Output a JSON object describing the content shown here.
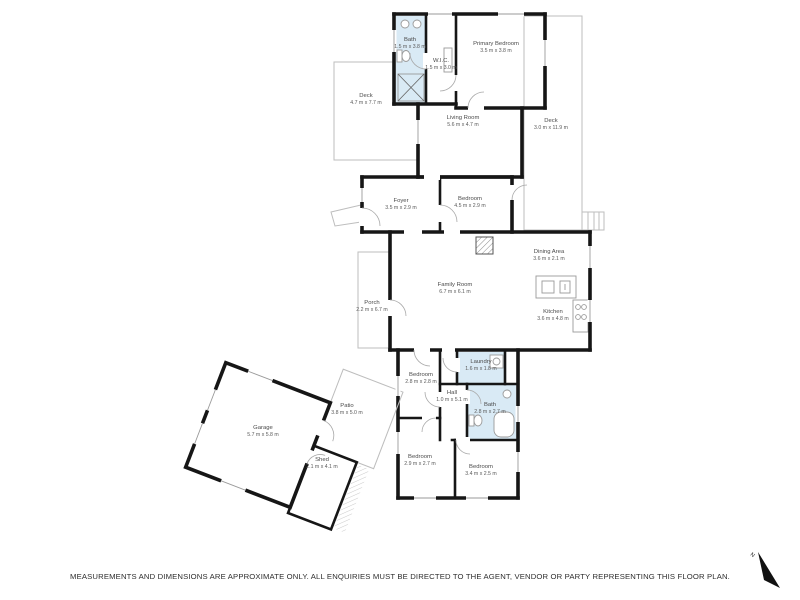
{
  "disclaimer": "MEASUREMENTS AND DIMENSIONS ARE APPROXIMATE ONLY. ALL ENQUIRIES MUST BE DIRECTED TO THE AGENT, VENDOR OR PARTY REPRESENTING THIS FLOOR PLAN.",
  "north_label": "N",
  "colors": {
    "wall": "#161616",
    "wet_room_fill": "#d9eaf5",
    "light_outline": "#bdbdbd",
    "label_text": "#4a4a4a"
  },
  "rooms": [
    {
      "id": "bath-upper",
      "name": "Bath",
      "dims": "1.5 m x 3.8 m"
    },
    {
      "id": "wic",
      "name": "W.I.C.",
      "dims": "1.5 m x 3.0 m"
    },
    {
      "id": "primary-bedroom",
      "name": "Primary Bedroom",
      "dims": "3.5 m x 3.8 m"
    },
    {
      "id": "deck-left",
      "name": "Deck",
      "dims": "4.7 m x 7.7 m"
    },
    {
      "id": "living-room",
      "name": "Living Room",
      "dims": "5.6 m x 4.7 m"
    },
    {
      "id": "deck-right",
      "name": "Deck",
      "dims": "3.0 m x 11.9 m"
    },
    {
      "id": "foyer",
      "name": "Foyer",
      "dims": "3.5 m x 2.9 m"
    },
    {
      "id": "bedroom-mid",
      "name": "Bedroom",
      "dims": "4.5 m x 2.9 m"
    },
    {
      "id": "dining-area",
      "name": "Dining Area",
      "dims": "3.6 m x 2.1 m"
    },
    {
      "id": "family-room",
      "name": "Family Room",
      "dims": "6.7 m x 6.1 m"
    },
    {
      "id": "kitchen",
      "name": "Kitchen",
      "dims": "3.6 m x 4.8 m"
    },
    {
      "id": "porch",
      "name": "Porch",
      "dims": "2.2 m x 6.7 m"
    },
    {
      "id": "bedroom-upper-left",
      "name": "Bedroom",
      "dims": "2.8 m x 2.8 m"
    },
    {
      "id": "laundry",
      "name": "Laundry",
      "dims": "1.6 m x 1.8 m"
    },
    {
      "id": "hall",
      "name": "Hall",
      "dims": "1.0 m x 5.1 m"
    },
    {
      "id": "bath-lower",
      "name": "Bath",
      "dims": "2.8 m x 2.7 m"
    },
    {
      "id": "bedroom-bottom-left",
      "name": "Bedroom",
      "dims": "2.9 m x 2.7 m"
    },
    {
      "id": "bedroom-bottom-right",
      "name": "Bedroom",
      "dims": "3.4 m x 2.5 m"
    },
    {
      "id": "garage",
      "name": "Garage",
      "dims": "5.7 m x 5.8 m"
    },
    {
      "id": "shed",
      "name": "Shed",
      "dims": "2.1 m x 4.1 m"
    },
    {
      "id": "patio",
      "name": "Patio",
      "dims": "3.8 m x 5.0 m"
    }
  ]
}
